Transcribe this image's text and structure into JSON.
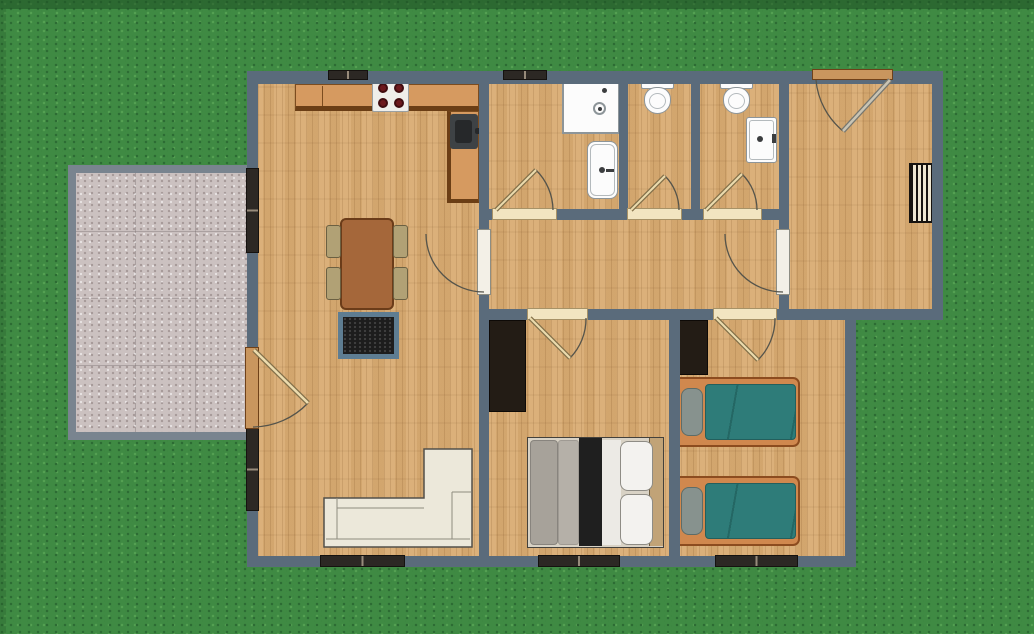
{
  "meta": {
    "view": "floor-plan-top-view",
    "setting": "single-storey house on lawn with patio"
  },
  "colors": {
    "grass": "#3f8a43",
    "grass-dark": "#2c6b33",
    "grass-light": "#54a052",
    "shade": "#1e4f23",
    "wall": "#5a6b7b",
    "floor": "#d9ac73",
    "patio": "#cbc1c0",
    "patio-border": "#79848f",
    "window-dark": "#2c2824",
    "window-mid": "#978b7b",
    "threshold": "#f2e5c1",
    "threshold-line": "#a79267",
    "door-tan": "#c9965e",
    "door-tan-line": "#6f4119",
    "bar-white": "#f3f0e7",
    "bar-white-line": "#8d8d83",
    "arc": "#55544b",
    "leaf-core": "#ecdcae",
    "leaf-edge": "#82704a",
    "front-leaf-core": "#c9c4b4",
    "front-leaf-edge": "#77776f",
    "counter": "#d69a60",
    "counter-edge": "#6b3e15",
    "counter-line": "#7c4c1f",
    "stove": "#efeeea",
    "stove-line": "#9aa0a2",
    "burner": "#6d191d",
    "burner-ring": "#410d10",
    "sink-unit": "#3e4245",
    "sink-basin": "#26282a",
    "fixture": "#fcfcfc",
    "fixture-line": "#8d9599",
    "fixture-inner": "#b4babd",
    "fixture-metal": "#3b3d3f",
    "cistern": "#38393c",
    "radiator-bg": "#efe7d2",
    "radiator-line": "#171310",
    "wardrobe": "#231c15",
    "table": "#a5673a",
    "table-line": "#6b3c19",
    "chair": "#b1a175",
    "chair-line": "#6b6042",
    "rug": "#1d1d1d",
    "rug-border": "#5e7d92",
    "rug-speck": "#404040",
    "sofa": "#ece8da",
    "sofa-line": "#53504a",
    "sofa-inner": "#8e8b7f",
    "bed-frame": "#d0884e",
    "bed-frame-line": "#8c4c1f",
    "mattress": "#2e7c79",
    "mattress-line": "#235f5d",
    "pillow": "#87928e",
    "pillow-line": "#5d6c68",
    "db-zone": "#d8d2c5",
    "db-line": "#44413b",
    "db-grey1": "#a7a29a",
    "db-grey2": "#b5b0a8",
    "db-black": "#1f1f1f",
    "db-white": "#eceae5",
    "db-pillow": "#f3f2ef",
    "db-pillow-line": "#8e8c85",
    "db-head": "#c1a377"
  },
  "plan": {
    "rooms": [
      {
        "name": "kitchen-living-room",
        "furniture": [
          "kitchen-counters",
          "stove",
          "kitchen-sink",
          "dining-table",
          "chair",
          "chair",
          "chair",
          "chair",
          "hearth-rug",
          "corner-sofa"
        ]
      },
      {
        "name": "bathroom",
        "furniture": [
          "shower",
          "bathtub"
        ]
      },
      {
        "name": "wc-1",
        "furniture": [
          "toilet"
        ]
      },
      {
        "name": "wc-2",
        "furniture": [
          "toilet",
          "washbasin"
        ]
      },
      {
        "name": "entry-hall",
        "furniture": [
          "radiator"
        ]
      },
      {
        "name": "hallway",
        "furniture": []
      },
      {
        "name": "bedroom-1",
        "furniture": [
          "wardrobe",
          "double-bed"
        ]
      },
      {
        "name": "bedroom-2",
        "furniture": [
          "wardrobe",
          "single-bed",
          "single-bed"
        ]
      },
      {
        "name": "patio",
        "furniture": []
      }
    ],
    "counts": {
      "doors": 9,
      "windows": 7,
      "beds": 3,
      "toilets": 2
    }
  }
}
